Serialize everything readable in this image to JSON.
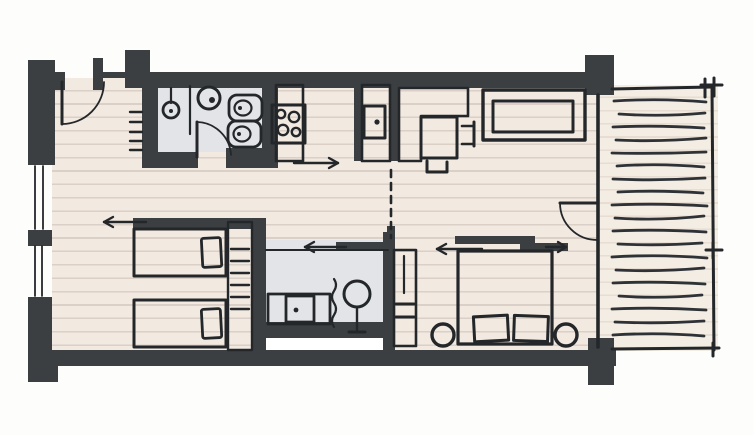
{
  "scene": {
    "label": "Hand-drawn architectural floor plan sketch of an apartment with one living-kitchen space, two bathrooms, a twin-bed room, a double bedroom and a wooden deck terrace on the right",
    "style": "freehand ink sketch, no text labels visible"
  },
  "palette": {
    "background": "#fdfdfc",
    "wall": "#3b3f42",
    "outline": "#24272a",
    "floor": "#f2e9e1",
    "floor_line": "#dbd0c8",
    "bath_floor": "#e3e4e7",
    "furniture_fill": "#d6cebc",
    "furniture_hatch": "#c5b9a2",
    "furniture_light": "#e2dac8",
    "pillow": "#efe9dd",
    "fixture_white": "#f7f5f0",
    "terrace": "#f4ede3",
    "terrace_line": "#e8ddd2",
    "deck_stroke": "#2e3236",
    "white_strip": "#ffffff"
  },
  "rooms": [
    {
      "id": "living-kitchen",
      "features": [
        "entrance-door",
        "kitchen-counter",
        "stove-4-burners",
        "kitchen-sink",
        "l-shaped-cabinet",
        "dining-table",
        "two-chairs",
        "sofa"
      ]
    },
    {
      "id": "bathroom-top",
      "features": [
        "shower",
        "partition",
        "round-washbasin",
        "toilet",
        "bidet",
        "swing-door",
        "radiator"
      ]
    },
    {
      "id": "twin-bed-room",
      "features": [
        "twin-bed",
        "twin-bed",
        "shelf-column",
        "sliding-door-left"
      ]
    },
    {
      "id": "shower-room",
      "features": [
        "vanity-washbasin",
        "plant",
        "towel-squiggle",
        "sliding-door-left",
        "tall-closet"
      ]
    },
    {
      "id": "double-bedroom",
      "features": [
        "double-bed",
        "two-pillows",
        "nightstand-round",
        "nightstand-round",
        "double-sliding-door",
        "terrace-swing-door"
      ]
    },
    {
      "id": "terrace",
      "features": [
        "deck-boards",
        "railing-posts",
        "glass-wall"
      ]
    }
  ],
  "counts": {
    "beds": 3,
    "toilets": 2,
    "washbasins": 2,
    "swing_doors": 3,
    "sliding_doors": 3,
    "windows_left_wall": 2,
    "deck_boards": 19,
    "burners": 4
  },
  "arrows": [
    {
      "id": "kitchen-flow",
      "direction": "right"
    },
    {
      "id": "twin-room-slide",
      "direction": "left"
    },
    {
      "id": "shower-room-slide",
      "direction": "left"
    },
    {
      "id": "bedroom-slide",
      "direction": "left"
    },
    {
      "id": "bedroom-slide-2",
      "direction": "right"
    }
  ],
  "divider": {
    "type": "dashed-line",
    "orientation": "vertical"
  }
}
